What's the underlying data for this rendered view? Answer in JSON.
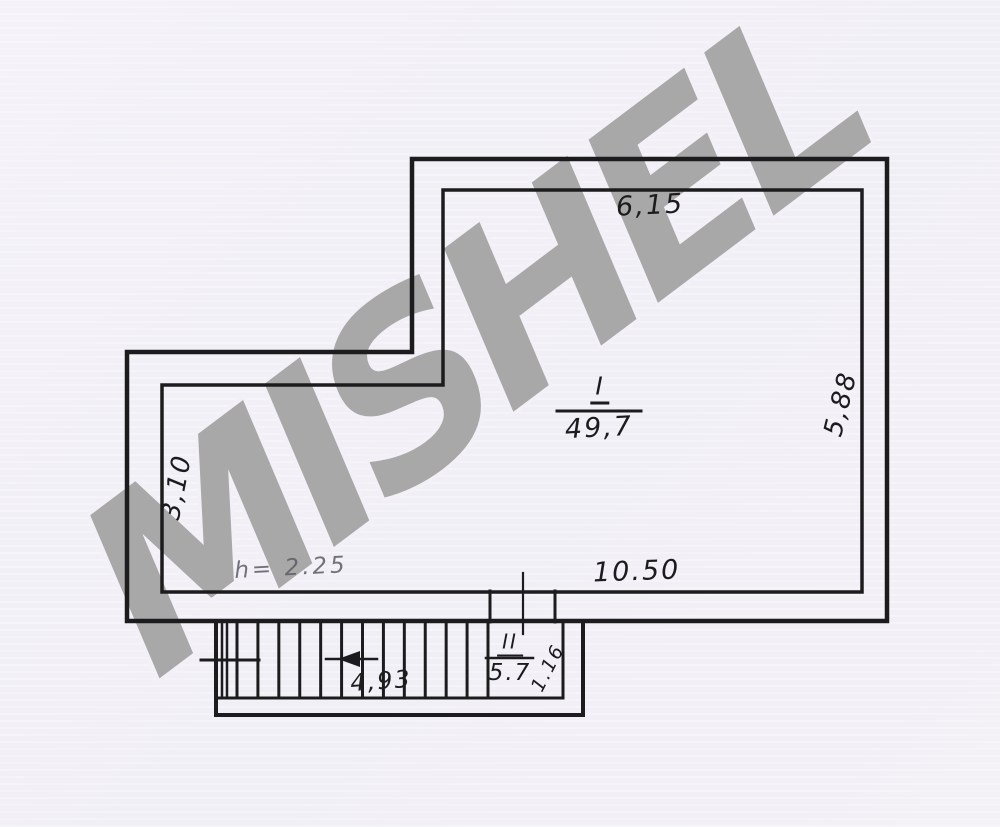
{
  "watermark": {
    "text": "MISHEL"
  },
  "plan": {
    "rooms": [
      {
        "number": "I",
        "area": "49,7"
      },
      {
        "number": "II",
        "area": "5.7"
      }
    ],
    "dimensions": {
      "top": "6,15",
      "right": "5,88",
      "left": "3,10",
      "bottom": "10.50",
      "stair_run": "4,93",
      "stair_width": "1.16",
      "ceiling_height": "h= 2.25"
    }
  },
  "colors": {
    "paper": "#f3f1f7",
    "ink": "#1c1c1e",
    "watermark": "#a8a8a8",
    "pencil": "#5c5c64"
  }
}
